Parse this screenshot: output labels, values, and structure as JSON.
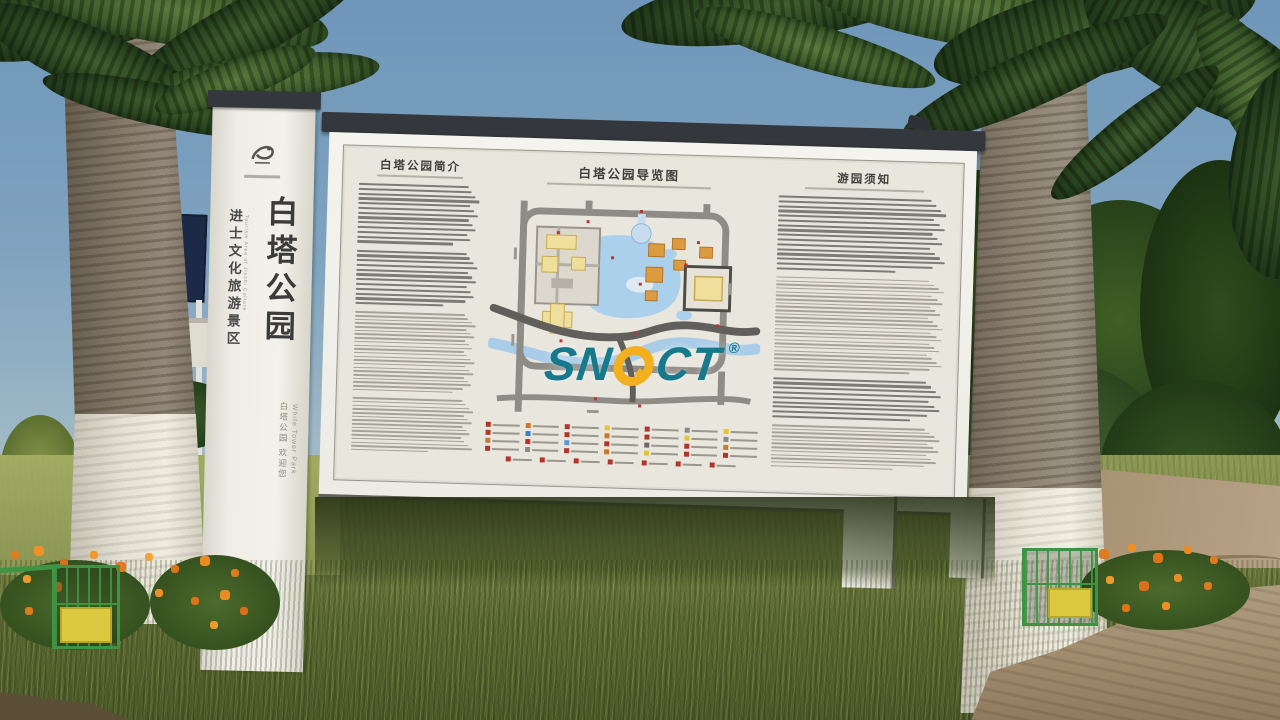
{
  "scene": {
    "pillar": {
      "title": "白塔公园",
      "area_label": "进士文化旅游景区",
      "area_label_en": "Tourism Area of Jinshi Culture",
      "side_label": "白塔公园 欢迎您",
      "side_label_en": "White Tower Park"
    },
    "board": {
      "intro_title": "白塔公园简介",
      "map_title": "白塔公园导览图",
      "notice_title": "游园须知"
    },
    "watermark": {
      "prefix": "SN",
      "suffix": "CT",
      "registered": "®"
    },
    "legend": {
      "colors": [
        "#b23529",
        "#c77a2f",
        "#b23529",
        "#e6c23a",
        "#b23529",
        "#8a8a8a",
        "#e6c23a",
        "#b23529",
        "#3b82c4",
        "#b23529",
        "#c77a2f",
        "#b23529",
        "#e6c23a",
        "#8a8a8a",
        "#c77a2f",
        "#b23529",
        "#5a9bd5",
        "#b23529",
        "#6b6b6b",
        "#b23529",
        "#c77a2f",
        "#b23529",
        "#8a8a8a",
        "#b23529",
        "#c77a2f",
        "#e6c23a",
        "#b23529",
        "#b23529"
      ],
      "bottom": [
        "#b23529",
        "#b23529",
        "#b23529",
        "#b23529",
        "#b23529",
        "#b23529",
        "#b23529"
      ]
    },
    "colors": {
      "watermark_teal": "#16798c",
      "watermark_yellow": "#f2b01e"
    }
  }
}
